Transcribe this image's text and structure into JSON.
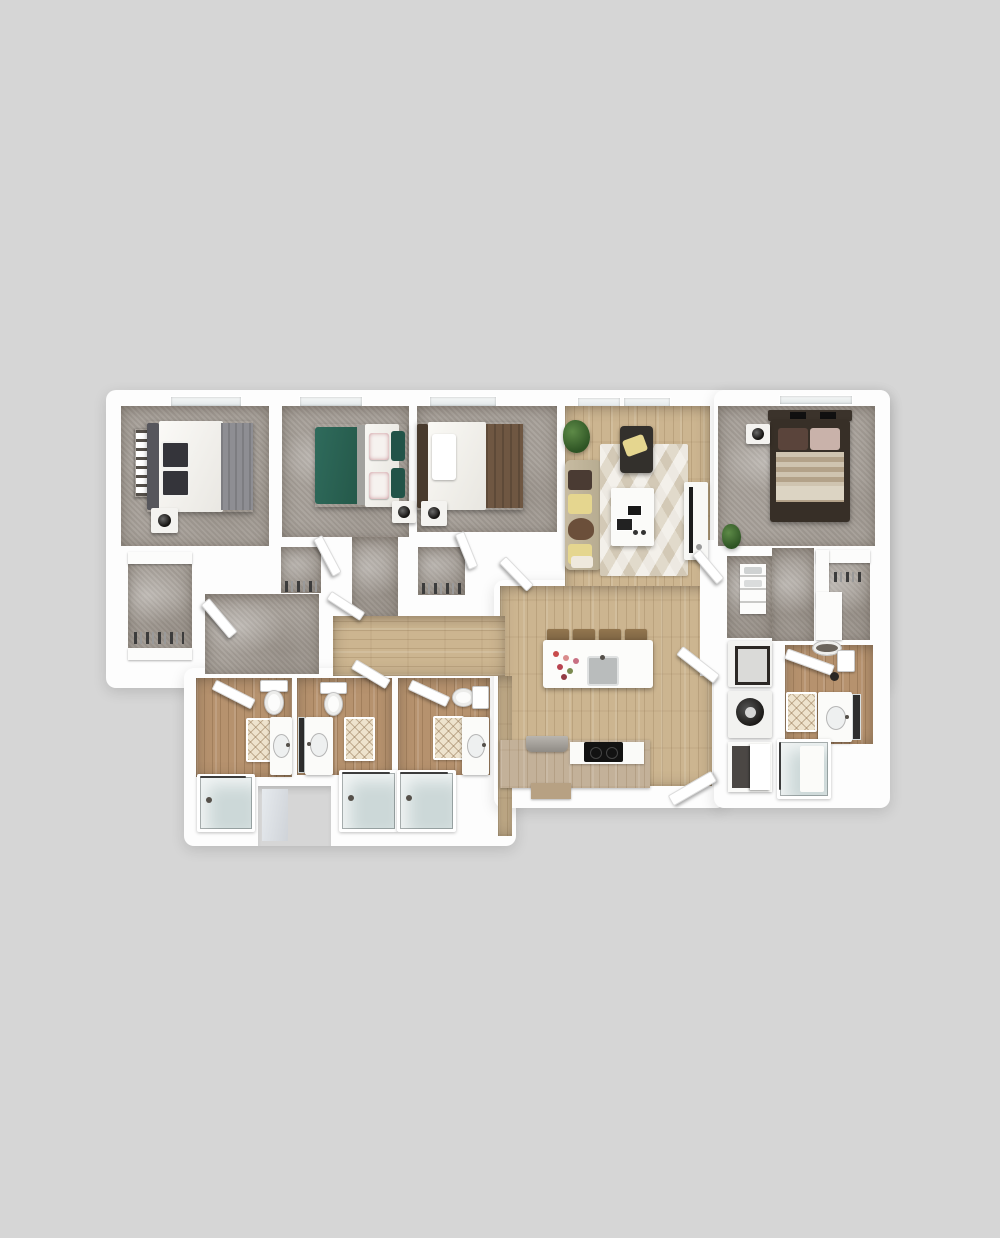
{
  "meta": {
    "description": "3D rendered top-down floor plan of a four-bedroom, four-bathroom apartment with open living/kitchen area and laundry closet",
    "background_color": "#d6d6d6"
  },
  "palette": {
    "bg": "#d6d6d6",
    "wall": "#fdfdfd",
    "carpet": "#a8a19a",
    "wood": "#ccb590",
    "wood_bath": "#b6926e",
    "cabinet": "#c3b199",
    "teal_bed": "#2f6b5c",
    "teal_dark": "#225348",
    "brown_blanket": "#6f5742",
    "gray_blanket": "#8e8e93",
    "dark_frame": "#372f27",
    "sofa": "#c7bba1",
    "pillow_yellow": "#e5d68f",
    "rug": "#e1dacb",
    "glass": "#ccd8d8",
    "appliance_dark": "#2b2724",
    "mat": "#eee3cd",
    "plant_green": "#3e6b33"
  },
  "rooms": [
    {
      "id": "bedroom-1",
      "label": "Bedroom 1",
      "floor": "carpet",
      "furniture": [
        "double-bed-white-duvet-gray-throw",
        "dark-headboard",
        "pillows",
        "nightstand-with-lamp",
        "wall-art-strip",
        "window"
      ]
    },
    {
      "id": "walk-in-closet-1",
      "label": "Walk-in Closet",
      "floor": "carpet",
      "furniture": [
        "shelf-top",
        "shelf-bottom",
        "hanging-clothes",
        "door"
      ]
    },
    {
      "id": "bedroom-2",
      "label": "Bedroom 2",
      "floor": "carpet",
      "furniture": [
        "double-bed-teal-duvet",
        "floral-pillows",
        "nightstand-with-lamp",
        "door",
        "window"
      ]
    },
    {
      "id": "closet-2",
      "label": "Closet",
      "floor": "carpet",
      "furniture": [
        "hanging-clothes",
        "door"
      ]
    },
    {
      "id": "bedroom-3",
      "label": "Bedroom 3",
      "floor": "carpet",
      "furniture": [
        "double-bed-white-duvet-brown-throw",
        "dark-headboard",
        "nightstand-with-lamp",
        "door",
        "window"
      ]
    },
    {
      "id": "closet-3",
      "label": "Closet",
      "floor": "carpet",
      "furniture": [
        "hanging-clothes",
        "door"
      ]
    },
    {
      "id": "hallway",
      "label": "Hallway",
      "floor": "carpet-and-hardwood",
      "furniture": []
    },
    {
      "id": "living-room",
      "label": "Living Room",
      "floor": "hardwood",
      "furniture": [
        "sofa-with-throw-pillows",
        "accent-chair-with-yellow-pillow",
        "geometric-area-rug",
        "coffee-table",
        "tv-console",
        "potted-plant",
        "windows"
      ]
    },
    {
      "id": "kitchen",
      "label": "Kitchen",
      "floor": "hardwood",
      "furniture": [
        "island-with-sink",
        "flower-bouquet",
        "bar-stools-x4",
        "cooktop",
        "base-cabinets",
        "countertop-appliance"
      ]
    },
    {
      "id": "entry",
      "label": "Entry",
      "floor": "hardwood",
      "furniture": [
        "entry-door",
        "hall-door"
      ]
    },
    {
      "id": "bathroom-1",
      "label": "Bathroom 1",
      "floor": "hardwood",
      "furniture": [
        "toilet",
        "vanity-sink",
        "bath-mat",
        "glass-bathtub",
        "door"
      ]
    },
    {
      "id": "bathroom-2",
      "label": "Bathroom 2",
      "floor": "hardwood",
      "furniture": [
        "toilet",
        "vanity-sink",
        "mirror",
        "bath-mat",
        "glass-bathtub",
        "door"
      ]
    },
    {
      "id": "bathroom-3",
      "label": "Bathroom 3",
      "floor": "hardwood",
      "furniture": [
        "toilet",
        "vanity-sink",
        "bath-mat",
        "glass-bathtub",
        "door"
      ]
    },
    {
      "id": "bedroom-4",
      "label": "Bedroom 4",
      "floor": "carpet",
      "furniture": [
        "bed-dark-frame-striped-duvet",
        "headboard-shelf-with-books",
        "nightstand-with-lamp",
        "potted-plant",
        "door"
      ]
    },
    {
      "id": "dressing-hall",
      "label": "Dressing Hall",
      "floor": "carpet",
      "furniture": []
    },
    {
      "id": "linen-closet",
      "label": "Linen Closet",
      "floor": "carpet",
      "furniture": [
        "shelving-unit",
        "towels"
      ]
    },
    {
      "id": "closet-4",
      "label": "Closet",
      "floor": "carpet",
      "furniture": [
        "l-shaped-shelving"
      ]
    },
    {
      "id": "laundry",
      "label": "Laundry / Utility",
      "floor": "none",
      "furniture": [
        "washer",
        "dryer",
        "utility-closet-door"
      ]
    },
    {
      "id": "bathroom-4",
      "label": "Bathroom 4",
      "floor": "hardwood",
      "furniture": [
        "toilet",
        "vanity-sink",
        "mirror",
        "bath-mat",
        "glass-shower",
        "door"
      ]
    }
  ]
}
